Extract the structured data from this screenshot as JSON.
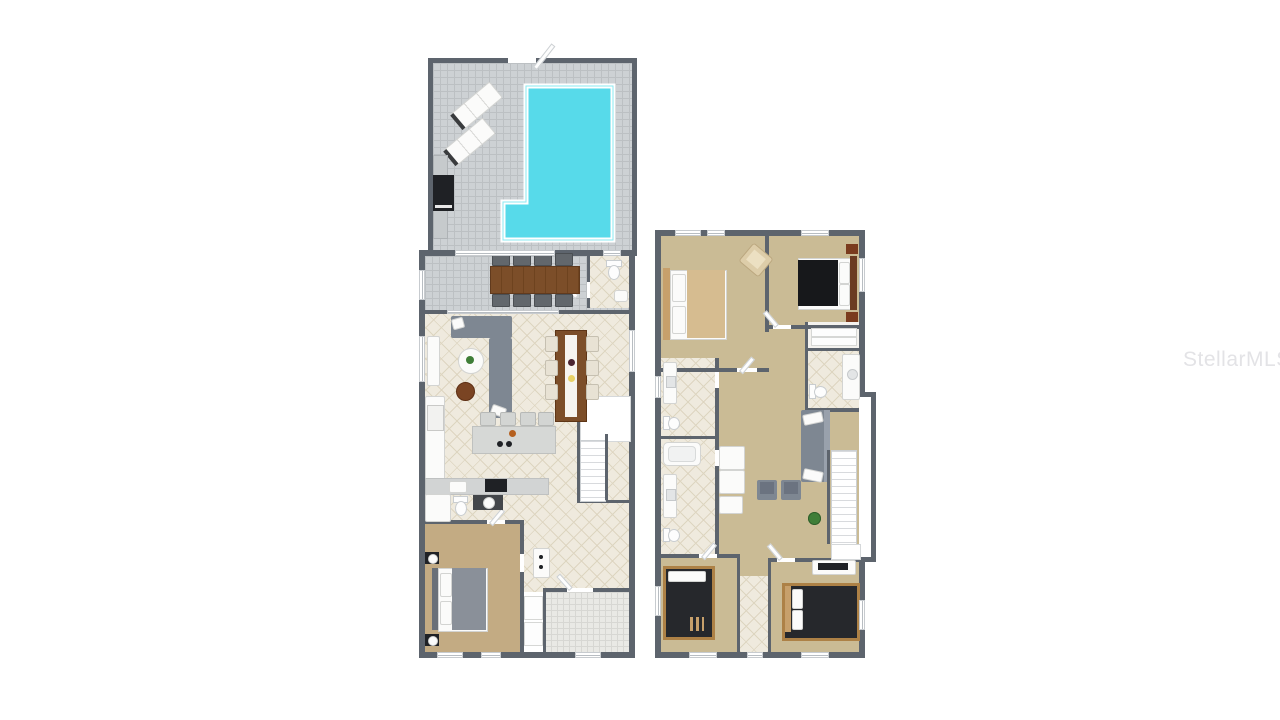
{
  "watermark": {
    "text": "StellarMLS"
  },
  "palette": {
    "wall": "#5d646d",
    "patio_tile": "#cdd1d4",
    "patio_grid": "#bcc0c3",
    "pool_water": "#57daea",
    "pool_border": "#ffffff",
    "interior_tile": "#efeade",
    "interior_line": "#ddd5c0",
    "porch_tile": "#e9e9e5",
    "porch_grid": "#d7d7d3",
    "carpet_first": "#c3ab83",
    "carpet_second": "#cabb95",
    "sofa": "#7e8792",
    "wood": "#7c4e29",
    "wood_light": "#c7a06b",
    "dark": "#1f2125",
    "beige": "#ddcda9",
    "counter": "#d2d4d4",
    "green": "#3f7e38",
    "watermark_color": "#e3e3e6"
  }
}
